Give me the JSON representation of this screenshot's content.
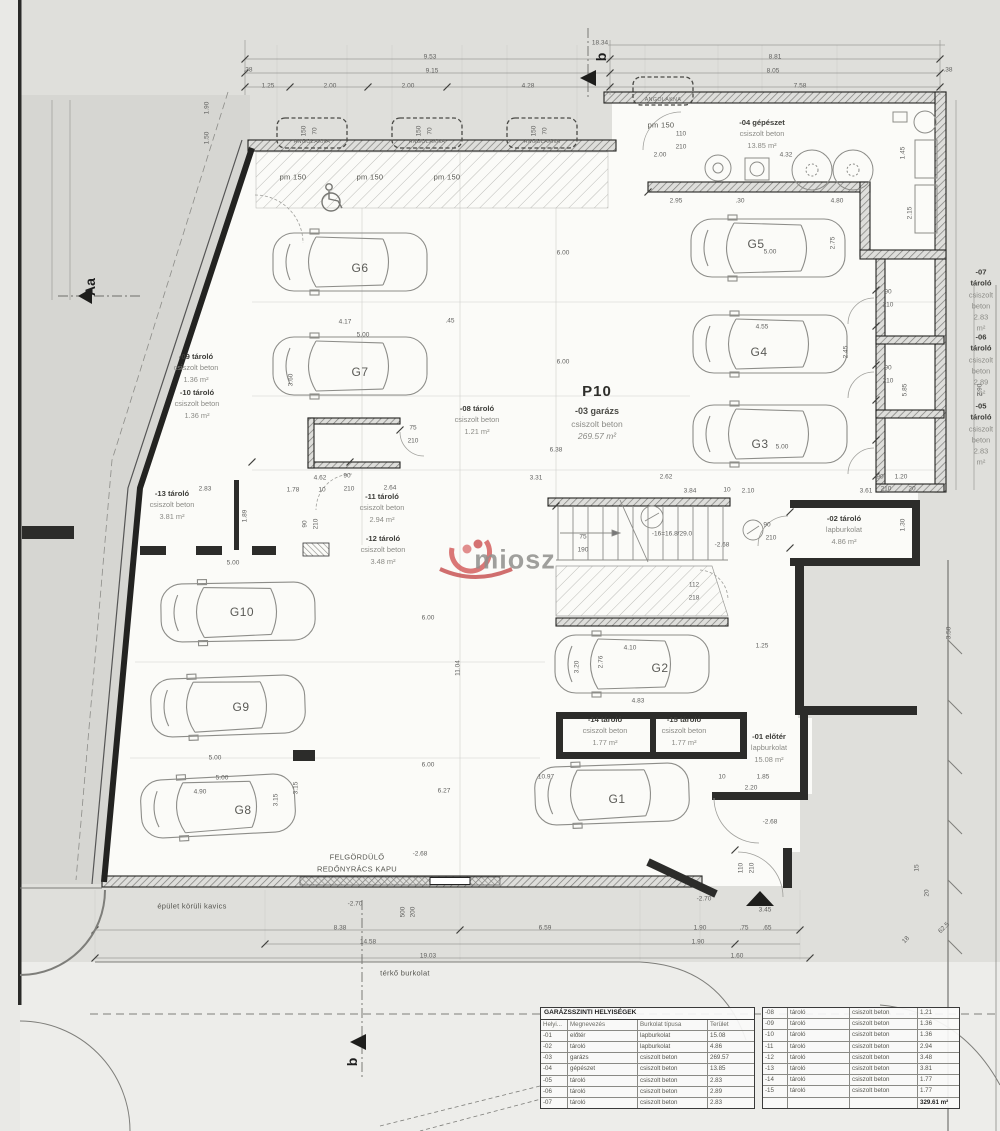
{
  "watermark": {
    "text": "miosz"
  },
  "garage": {
    "code": "P10",
    "name": "-03 garázs",
    "material": "csiszolt beton",
    "area": "269.57 m²"
  },
  "room_labels": [
    {
      "name": "-09 tároló",
      "material": "csiszolt beton",
      "area": "1.36 m²",
      "x": 196,
      "y": 368
    },
    {
      "name": "-10 tároló",
      "material": "csiszolt beton",
      "area": "1.36 m²",
      "x": 197,
      "y": 404
    },
    {
      "name": "-13 tároló",
      "material": "csiszolt beton",
      "area": "3.81 m²",
      "x": 172,
      "y": 505
    },
    {
      "name": "-11 tároló",
      "material": "csiszolt beton",
      "area": "2.94 m²",
      "x": 382,
      "y": 508
    },
    {
      "name": "-12 tároló",
      "material": "csiszolt beton",
      "area": "3.48 m²",
      "x": 383,
      "y": 550
    },
    {
      "name": "-08 tároló",
      "material": "csiszolt beton",
      "area": "1.21 m²",
      "x": 477,
      "y": 420
    },
    {
      "name": "-04 gépészet",
      "material": "csiszolt beton",
      "area": "13.85 m²",
      "x": 762,
      "y": 134
    },
    {
      "name": "-07 tároló",
      "material": "csiszolt beton",
      "area": "2.83 m²",
      "x": 981,
      "y": 300
    },
    {
      "name": "-06 tároló",
      "material": "csiszolt beton",
      "area": "2.89 m²",
      "x": 981,
      "y": 365
    },
    {
      "name": "-05 tároló",
      "material": "csiszolt beton",
      "area": "2.83 m²",
      "x": 981,
      "y": 434
    },
    {
      "name": "-02 tároló",
      "material": "lapburkolat",
      "area": "4.86 m²",
      "x": 844,
      "y": 530
    },
    {
      "name": "-14 tároló",
      "material": "csiszolt beton",
      "area": "1.77 m²",
      "x": 605,
      "y": 731
    },
    {
      "name": "-15 tároló",
      "material": "csiszolt beton",
      "area": "1.77 m²",
      "x": 684,
      "y": 731
    },
    {
      "name": "-01 előtér",
      "material": "lapburkolat",
      "area": "15.08 m²",
      "x": 769,
      "y": 748
    }
  ],
  "parking_spots": [
    {
      "t": "G1",
      "x": 617,
      "y": 799
    },
    {
      "t": "G2",
      "x": 660,
      "y": 668
    },
    {
      "t": "G3",
      "x": 760,
      "y": 444
    },
    {
      "t": "G4",
      "x": 759,
      "y": 352
    },
    {
      "t": "G5",
      "x": 756,
      "y": 244
    },
    {
      "t": "G6",
      "x": 360,
      "y": 268
    },
    {
      "t": "G7",
      "x": 360,
      "y": 372
    },
    {
      "t": "G8",
      "x": 243,
      "y": 810
    },
    {
      "t": "G9",
      "x": 241,
      "y": 707
    },
    {
      "t": "G10",
      "x": 242,
      "y": 612
    }
  ],
  "notes": [
    {
      "t": "FELGÖRDÜLŐ",
      "x": 357,
      "y": 857,
      "cls": "note"
    },
    {
      "t": "REDŐNYRÁCS KAPU",
      "x": 357,
      "y": 869,
      "cls": "note"
    },
    {
      "t": "épület körüli kavics",
      "x": 192,
      "y": 906,
      "cls": "note"
    },
    {
      "t": "térkő burkolat",
      "x": 405,
      "y": 973,
      "cls": "note"
    },
    {
      "t": "ANGOLAKNA",
      "x": 312,
      "y": 142,
      "cls": "xs"
    },
    {
      "t": "ANGOLAKNA",
      "x": 427,
      "y": 142,
      "cls": "xs"
    },
    {
      "t": "ANGOLAKNA",
      "x": 542,
      "y": 142,
      "cls": "xs"
    },
    {
      "t": "ANGOLAKNA",
      "x": 663,
      "y": 100,
      "cls": "xs"
    },
    {
      "t": "pm 150",
      "x": 293,
      "y": 177,
      "cls": "note"
    },
    {
      "t": "pm 150",
      "x": 370,
      "y": 177,
      "cls": "note"
    },
    {
      "t": "pm 150",
      "x": 447,
      "y": 177,
      "cls": "note"
    },
    {
      "t": "pm 150",
      "x": 661,
      "y": 125,
      "cls": "note"
    },
    {
      "t": "-16=16.8/29.0",
      "x": 672,
      "y": 534,
      "cls": "dim"
    },
    {
      "t": "-2.68",
      "x": 722,
      "y": 545,
      "cls": "dim"
    },
    {
      "t": "-2.68",
      "x": 770,
      "y": 822,
      "cls": "dim"
    },
    {
      "t": "-2.68",
      "x": 420,
      "y": 854,
      "cls": "dim"
    },
    {
      "t": "-2.70",
      "x": 355,
      "y": 904,
      "cls": "dim"
    },
    {
      "t": "-2.70",
      "x": 704,
      "y": 899,
      "cls": "dim"
    },
    {
      "t": "b",
      "x": 601,
      "y": 57,
      "cls": "marker",
      "r": -90
    },
    {
      "t": "b",
      "x": 352,
      "y": 1062,
      "cls": "marker",
      "r": -90
    },
    {
      "t": "Aa",
      "x": 90,
      "y": 287,
      "cls": "marker",
      "r": -90
    }
  ],
  "dimensions": [
    {
      "t": "18.34",
      "x": 600,
      "y": 43
    },
    {
      "t": "9.53",
      "x": 430,
      "y": 57
    },
    {
      "t": "9.15",
      "x": 432,
      "y": 71
    },
    {
      "t": "1.25",
      "x": 268,
      "y": 86
    },
    {
      "t": "2.00",
      "x": 330,
      "y": 86
    },
    {
      "t": "2.00",
      "x": 408,
      "y": 86
    },
    {
      "t": "4.28",
      "x": 528,
      "y": 86
    },
    {
      "t": "8.81",
      "x": 775,
      "y": 57
    },
    {
      "t": "8.05",
      "x": 773,
      "y": 71
    },
    {
      "t": "7.58",
      "x": 800,
      "y": 86
    },
    {
      "t": ".38",
      "x": 248,
      "y": 70
    },
    {
      "t": ".38",
      "x": 948,
      "y": 70
    },
    {
      "t": "1.90",
      "x": 207,
      "y": 108,
      "r": -90
    },
    {
      "t": "1.50",
      "x": 207,
      "y": 138,
      "r": -90
    },
    {
      "t": "150",
      "x": 304,
      "y": 131,
      "r": -90
    },
    {
      "t": "70",
      "x": 315,
      "y": 131,
      "r": -90
    },
    {
      "t": "150",
      "x": 419,
      "y": 131,
      "r": -90
    },
    {
      "t": "70",
      "x": 430,
      "y": 131,
      "r": -90
    },
    {
      "t": "150",
      "x": 534,
      "y": 131,
      "r": -90
    },
    {
      "t": "70",
      "x": 545,
      "y": 131,
      "r": -90
    },
    {
      "t": "110",
      "x": 681,
      "y": 134
    },
    {
      "t": "210",
      "x": 681,
      "y": 147
    },
    {
      "t": "2.00",
      "x": 660,
      "y": 155
    },
    {
      "t": "4.32",
      "x": 786,
      "y": 155
    },
    {
      "t": "1.45",
      "x": 903,
      "y": 153,
      "r": -90
    },
    {
      "t": "2.15",
      "x": 910,
      "y": 213,
      "r": -90
    },
    {
      "t": "2.95",
      "x": 676,
      "y": 201
    },
    {
      "t": ".30",
      "x": 740,
      "y": 201
    },
    {
      "t": "4.80",
      "x": 837,
      "y": 201
    },
    {
      "t": "6.00",
      "x": 563,
      "y": 253
    },
    {
      "t": "6.00",
      "x": 563,
      "y": 362
    },
    {
      "t": "6.38",
      "x": 556,
      "y": 450
    },
    {
      "t": "4.17",
      "x": 345,
      "y": 322
    },
    {
      "t": ".45",
      "x": 450,
      "y": 321
    },
    {
      "t": "5.00",
      "x": 363,
      "y": 335
    },
    {
      "t": "3.60",
      "x": 291,
      "y": 380,
      "r": -90
    },
    {
      "t": "5.00",
      "x": 770,
      "y": 252
    },
    {
      "t": "2.75",
      "x": 833,
      "y": 243,
      "r": -90
    },
    {
      "t": "4.55",
      "x": 762,
      "y": 327
    },
    {
      "t": "2.45",
      "x": 846,
      "y": 352,
      "r": -90
    },
    {
      "t": "5.00",
      "x": 782,
      "y": 447
    },
    {
      "t": "90",
      "x": 888,
      "y": 292
    },
    {
      "t": "210",
      "x": 888,
      "y": 305
    },
    {
      "t": "90",
      "x": 888,
      "y": 368
    },
    {
      "t": "210",
      "x": 888,
      "y": 381
    },
    {
      "t": "2.90",
      "x": 980,
      "y": 390,
      "r": -90
    },
    {
      "t": "5.85",
      "x": 905,
      "y": 390,
      "r": -90
    },
    {
      "t": "90",
      "x": 880,
      "y": 477
    },
    {
      "t": "1.20",
      "x": 901,
      "y": 477
    },
    {
      "t": "210",
      "x": 886,
      "y": 489
    },
    {
      "t": "20",
      "x": 912,
      "y": 489
    },
    {
      "t": "3.31",
      "x": 536,
      "y": 478
    },
    {
      "t": "2.62",
      "x": 666,
      "y": 477
    },
    {
      "t": "3.84",
      "x": 690,
      "y": 491
    },
    {
      "t": "10",
      "x": 727,
      "y": 490
    },
    {
      "t": "2.10",
      "x": 748,
      "y": 491
    },
    {
      "t": "3.61",
      "x": 866,
      "y": 491
    },
    {
      "t": "2.83",
      "x": 205,
      "y": 489
    },
    {
      "t": "1.78",
      "x": 293,
      "y": 490
    },
    {
      "t": "10",
      "x": 322,
      "y": 490
    },
    {
      "t": "2.64",
      "x": 390,
      "y": 488
    },
    {
      "t": "4.62",
      "x": 320,
      "y": 478
    },
    {
      "t": "90",
      "x": 347,
      "y": 476
    },
    {
      "t": "210",
      "x": 349,
      "y": 489
    },
    {
      "t": "1.89",
      "x": 245,
      "y": 516,
      "r": -90
    },
    {
      "t": "90",
      "x": 305,
      "y": 524,
      "r": -90
    },
    {
      "t": "210",
      "x": 316,
      "y": 524,
      "r": -90
    },
    {
      "t": "75",
      "x": 413,
      "y": 428
    },
    {
      "t": "210",
      "x": 413,
      "y": 441
    },
    {
      "t": "75",
      "x": 583,
      "y": 537
    },
    {
      "t": "190",
      "x": 583,
      "y": 550
    },
    {
      "t": "90",
      "x": 767,
      "y": 525
    },
    {
      "t": "210",
      "x": 771,
      "y": 538
    },
    {
      "t": "112",
      "x": 694,
      "y": 585
    },
    {
      "t": "218",
      "x": 694,
      "y": 598
    },
    {
      "t": "6.00",
      "x": 428,
      "y": 618
    },
    {
      "t": "11.04",
      "x": 458,
      "y": 668,
      "r": -90
    },
    {
      "t": "4.10",
      "x": 630,
      "y": 648
    },
    {
      "t": "4.83",
      "x": 638,
      "y": 701
    },
    {
      "t": "3.20",
      "x": 577,
      "y": 667,
      "r": -90
    },
    {
      "t": "2.76",
      "x": 601,
      "y": 662,
      "r": -90
    },
    {
      "t": "1.25",
      "x": 762,
      "y": 646
    },
    {
      "t": "3.50",
      "x": 949,
      "y": 633,
      "r": -90
    },
    {
      "t": "1.30",
      "x": 903,
      "y": 525,
      "r": -90
    },
    {
      "t": "6.00",
      "x": 428,
      "y": 765
    },
    {
      "t": "10.97",
      "x": 546,
      "y": 777
    },
    {
      "t": "6.27",
      "x": 444,
      "y": 791
    },
    {
      "t": "5.00",
      "x": 215,
      "y": 758
    },
    {
      "t": "5.00",
      "x": 222,
      "y": 778
    },
    {
      "t": "4.90",
      "x": 200,
      "y": 792
    },
    {
      "t": "3.15",
      "x": 276,
      "y": 800,
      "r": -90
    },
    {
      "t": "3.15",
      "x": 296,
      "y": 788,
      "r": -90
    },
    {
      "t": "5.00",
      "x": 233,
      "y": 563
    },
    {
      "t": "10",
      "x": 722,
      "y": 777
    },
    {
      "t": "1.85",
      "x": 763,
      "y": 777
    },
    {
      "t": "2.20",
      "x": 751,
      "y": 788
    },
    {
      "t": "3.45",
      "x": 765,
      "y": 910
    },
    {
      "t": "110",
      "x": 741,
      "y": 868,
      "r": -90
    },
    {
      "t": "210",
      "x": 752,
      "y": 868,
      "r": -90
    },
    {
      "t": "500",
      "x": 403,
      "y": 912,
      "r": -90
    },
    {
      "t": "200",
      "x": 413,
      "y": 912,
      "r": -90
    },
    {
      "t": "8.38",
      "x": 340,
      "y": 928
    },
    {
      "t": "14.58",
      "x": 368,
      "y": 942
    },
    {
      "t": "19.03",
      "x": 428,
      "y": 956
    },
    {
      "t": "6.59",
      "x": 545,
      "y": 928
    },
    {
      "t": "1.90",
      "x": 700,
      "y": 928
    },
    {
      "t": ".75",
      "x": 744,
      "y": 928
    },
    {
      "t": ".65",
      "x": 767,
      "y": 928
    },
    {
      "t": "1.90",
      "x": 698,
      "y": 942
    },
    {
      "t": "1.60",
      "x": 737,
      "y": 956
    },
    {
      "t": "15",
      "x": 917,
      "y": 868,
      "r": -90
    },
    {
      "t": "20",
      "x": 927,
      "y": 893,
      "r": -90
    },
    {
      "t": "62.5",
      "x": 944,
      "y": 928,
      "r": -45
    },
    {
      "t": "18",
      "x": 906,
      "y": 940,
      "r": -45
    }
  ],
  "legend": {
    "title": "GARÁZSSZINTI HELYISÉGEK",
    "headers": [
      "Helyi...",
      "Megnevezés",
      "Burkolat típusa",
      "Terület"
    ],
    "rows_left": [
      [
        "-01",
        "előtér",
        "lapburkolat",
        "15.08"
      ],
      [
        "-02",
        "tároló",
        "lapburkolat",
        "4.86"
      ],
      [
        "-03",
        "garázs",
        "csiszolt beton",
        "269.57"
      ],
      [
        "-04",
        "gépészet",
        "csiszolt beton",
        "13.85"
      ],
      [
        "-05",
        "tároló",
        "csiszolt beton",
        "2.83"
      ],
      [
        "-06",
        "tároló",
        "csiszolt beton",
        "2.89"
      ],
      [
        "-07",
        "tároló",
        "csiszolt beton",
        "2.83"
      ]
    ],
    "rows_right": [
      [
        "-08",
        "tároló",
        "csiszolt beton",
        "1.21"
      ],
      [
        "-09",
        "tároló",
        "csiszolt beton",
        "1.36"
      ],
      [
        "-10",
        "tároló",
        "csiszolt beton",
        "1.36"
      ],
      [
        "-11",
        "tároló",
        "csiszolt beton",
        "2.94"
      ],
      [
        "-12",
        "tároló",
        "csiszolt beton",
        "3.48"
      ],
      [
        "-13",
        "tároló",
        "csiszolt beton",
        "3.81"
      ],
      [
        "-14",
        "tároló",
        "csiszolt beton",
        "1.77"
      ],
      [
        "-15",
        "tároló",
        "csiszolt beton",
        "1.77"
      ],
      [
        "",
        "",
        "",
        "329.61 m²"
      ]
    ],
    "total": "329.61 m²"
  }
}
